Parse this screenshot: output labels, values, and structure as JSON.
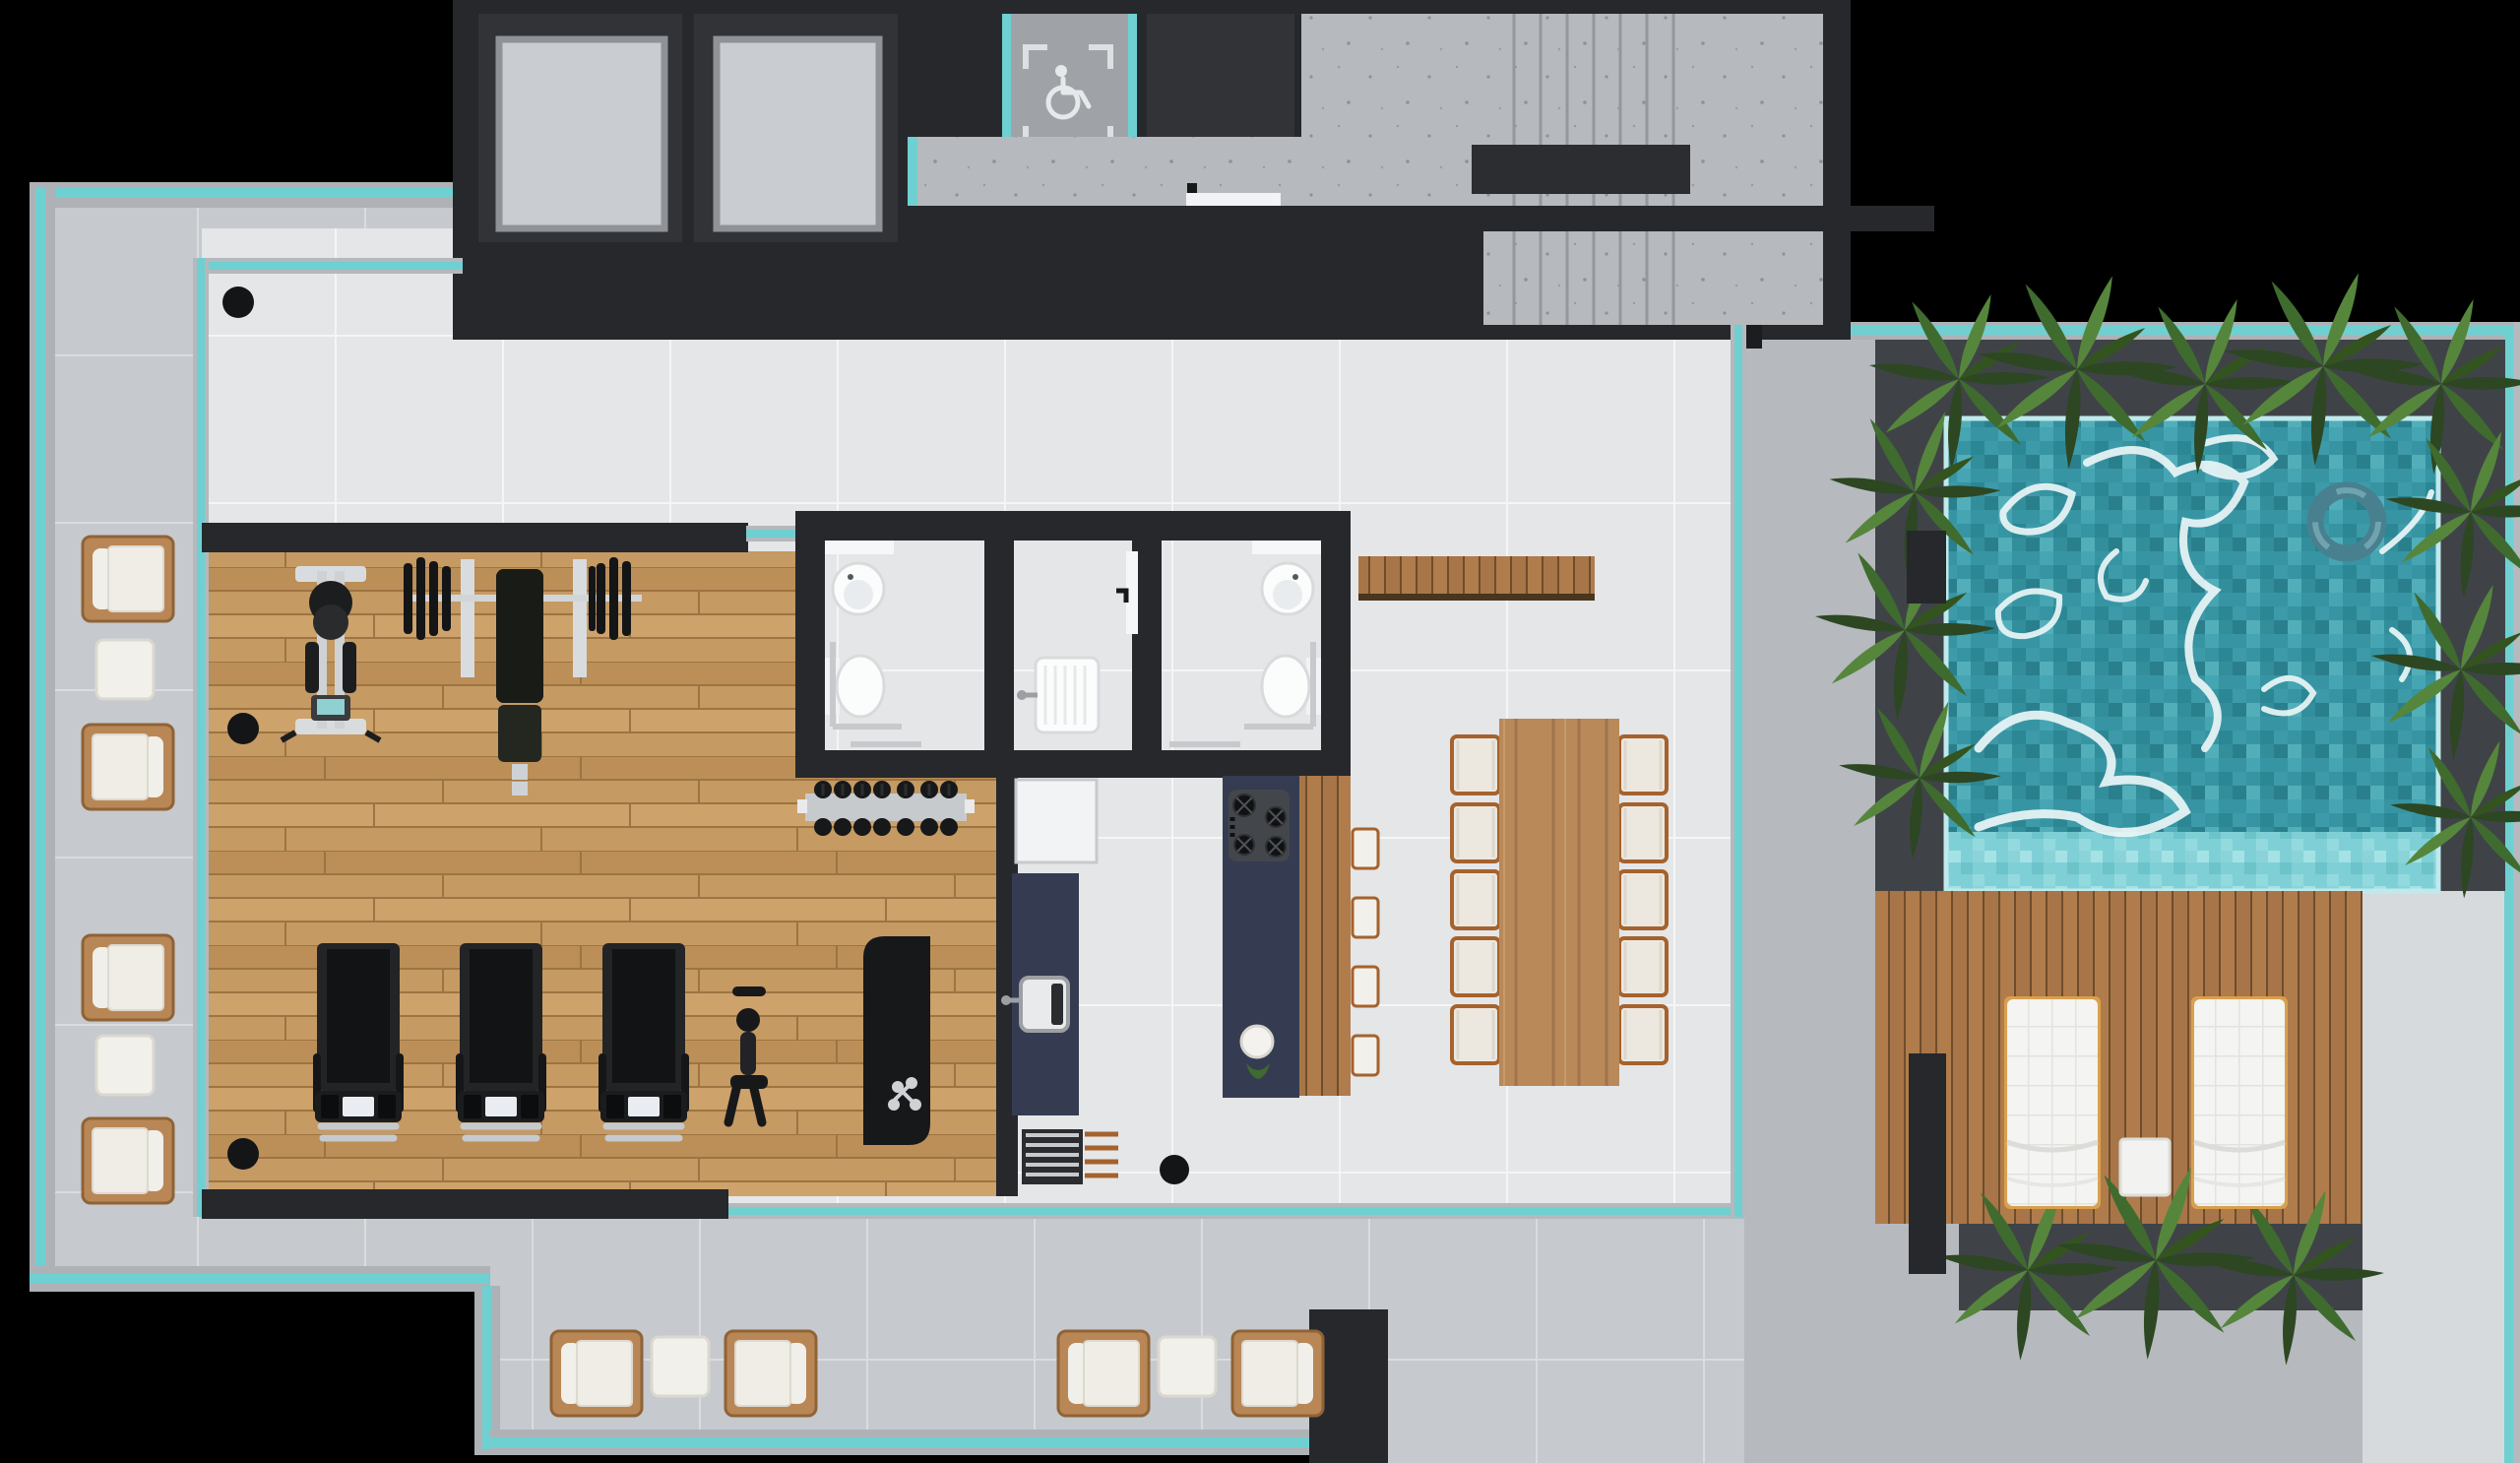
{
  "meta": {
    "title": "Residential amenities floor – top-view 3D render",
    "view": "top-down architectural render",
    "visible_text": "none"
  },
  "palette": {
    "background": "#000000",
    "coreWall": "#26282c",
    "shaftInterior": "#313337",
    "elevatorCar": "#c9ccd0",
    "elevatorFrame": "#8f9397",
    "concrete": "#b6b9bd",
    "concreteBand": "#aeb2b6",
    "tealGlass": "#6fd0d2",
    "terraceTile": "#c6c9cd",
    "indoorTile": "#e4e6e8",
    "gymWood": "#c59a63",
    "deckWood": "#b07c4c",
    "diningWood": "#b9895a",
    "navyCounter": "#353c52",
    "cream": "#f1efe9",
    "rattan": "#b98756",
    "equipment": "#1c1d1f",
    "poolBase": "#3795a3",
    "poolLedge": "#7fd0d6",
    "caustic": "#eef8f9",
    "plantDark": "#2c4722",
    "plantMid": "#3f6b2f",
    "plantLight": "#55863c",
    "planterBox": "#3f4347",
    "chrome": "#c7cacd",
    "white": "#f4f4f2"
  },
  "core": {
    "elevators": 2,
    "accessible_lift": {
      "icon": "wheelchair-icon",
      "marking": "dashed corner brackets"
    },
    "service_shaft": 1,
    "staircase": {
      "flights": 2,
      "mid_void": true
    },
    "corridor_door": 1
  },
  "rooms": {
    "gym": {
      "floor": "wood",
      "equipment": [
        "lat-pulldown-machine",
        "bench-press",
        "dumbbell-rack",
        "exercise-mat",
        "treadmill",
        "treadmill",
        "treadmill",
        "spin-bike"
      ]
    },
    "bathrooms": {
      "count": 2,
      "accessible": true,
      "fixtures_each": [
        "wall-sink",
        "toilet",
        "grab-bar",
        "towel-bar"
      ],
      "utility_room": {
        "fixtures": [
          "laundry-sink",
          "door"
        ]
      }
    },
    "kitchen": {
      "appliances": [
        "refrigerator",
        "counter-sink",
        "barbecue-grill"
      ],
      "island": {
        "cooktop_burners": 4,
        "bar_stools": 4,
        "salad_bowl": 1
      }
    },
    "dining": {
      "table_seats": 10,
      "chairs_per_side": 5,
      "sideboard_bench": 1
    },
    "indoor_lounge": {
      "round_columns": 4
    }
  },
  "terrace": {
    "left_seating": {
      "armchairs": 4,
      "ottomans": 2
    },
    "bottom_seating": {
      "armchairs": 4,
      "ottomans": 2
    },
    "glass_balustrade": true
  },
  "pool_area": {
    "pool": {
      "finish": "mosaic tile",
      "float_ring": 1,
      "shallow_ledge": true
    },
    "deck": {
      "sun_loungers": 2,
      "side_table": 1,
      "boards": "vertical wood"
    },
    "planters_with_palms": 4,
    "side_walkway": true
  }
}
